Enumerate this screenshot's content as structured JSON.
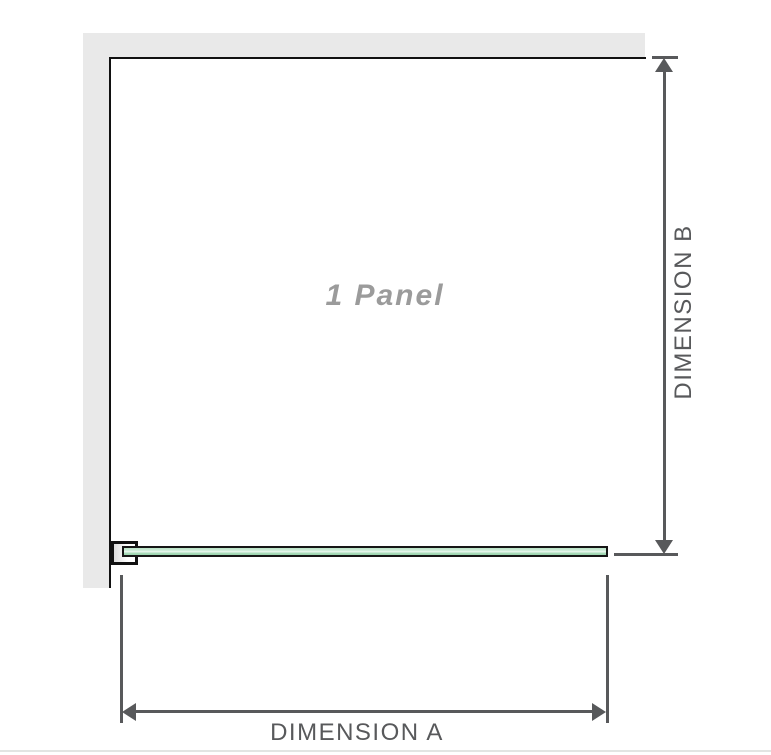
{
  "diagram": {
    "panel_label": "1 Panel",
    "dimension_a": {
      "label": "DIMENSION A"
    },
    "dimension_b": {
      "label": "DIMENSION B"
    },
    "colors": {
      "wall_gray": "#e9e9e9",
      "outline_black": "#111111",
      "dimension_gray": "#58595b",
      "panel_label_gray": "#9b9b9b",
      "glass_green": "#b7e2c5",
      "glass_highlight": "#ecf8f0",
      "glass_green_dark": "#9bd4ae"
    }
  }
}
